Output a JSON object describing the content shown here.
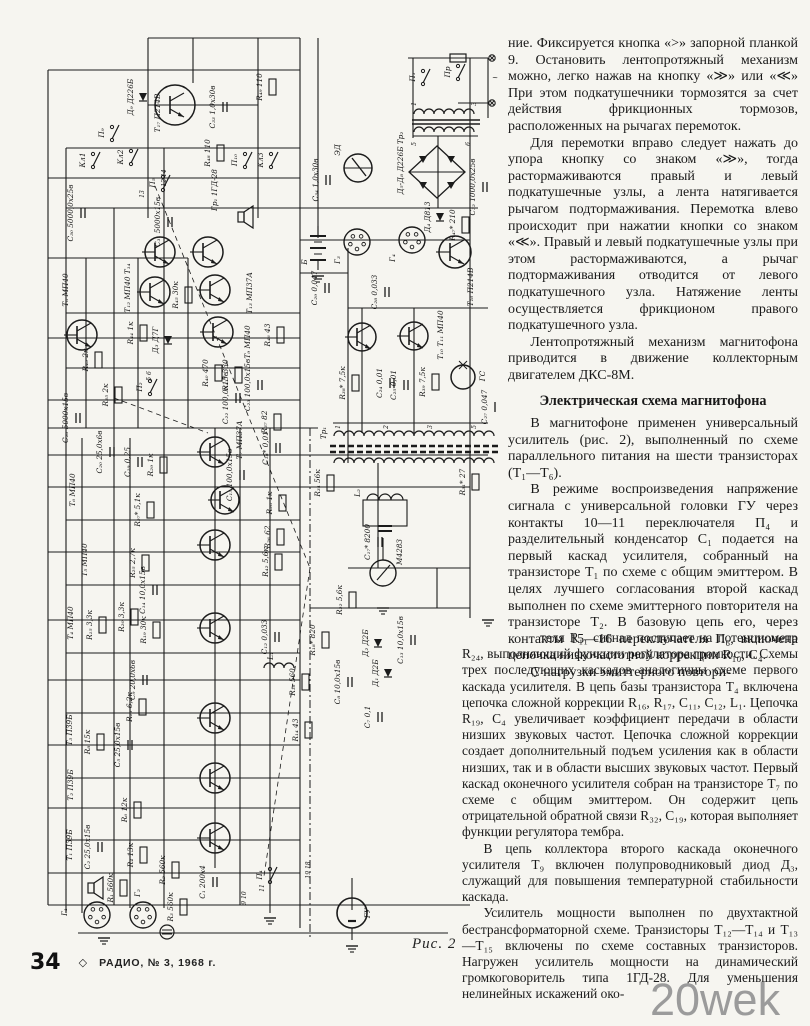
{
  "page": {
    "background": "#f6f5f0",
    "ink": "#1b1b1b"
  },
  "article": {
    "column_top": [
      {
        "style": "cont",
        "text": "ние. Фиксируется кнопка «>» запорной планкой 9. Остановить лентопротяжный механизм можно, легко нажав на кнопку «≫» или «≪» При этом подкатушечники тормозятся за счет действия фрикционных тормозов, расположенных на рычагах перемоток."
      },
      {
        "style": "p",
        "text": "Для перемотки вправо следует нажать до упора кнопку со знаком «≫», тогда растормаживаются правый и левый подкатушечные узлы, а лента натягивается рычагом подтормаживания. Перемотка влево происходит при нажатии кнопки со знаком «≪». Правый и левый подкатушечные узлы при этом растормаживаются, а рычаг подтормаживания отводится от левого подкатушечного узла. Натяжение ленты осуществляется фрикционом правого подкатушечного узла."
      },
      {
        "style": "p",
        "text": "Лентопротяжный механизм магнитофона приводится в движение коллекторным двигателем ДКС-8М."
      },
      {
        "style": "h",
        "text": "Электрическая схема магнитофона"
      },
      {
        "style": "p",
        "text": "В магнитофоне применен универсальный усилитель (рис. 2), выполненный по схеме параллельного питания на шести транзисторах (Т₁—Т₆)."
      },
      {
        "style": "p",
        "text": "В режиме воспроизведения напряжение сигнала с универсальной головки ГУ через контакты 10—11 переключателя П₄ и разделительный конденсатор С₁ подается на первый каскад усилителя, собранный на транзисторе Т₁ по схеме с общим эмиттером. В целях лучшего согласования второй каскад выполнен по схеме эмиттерного повторителя на транзисторе Т₂. В базовую цепь его, через контакты 15—16 переключателя П₆, включена цепочка низкочастотной коррекции R₁₀, С₄."
      },
      {
        "style": "p",
        "text": "С нагрузки эмиттерного повтори-"
      }
    ],
    "column_bottom": [
      {
        "style": "contind",
        "text": "теля R₁₁ сигнал поступает на потенциометр R₂₄, выполняющий функции регулятора громкости. Схемы трех последующих каскадов аналогичны схеме первого каскада усилителя. В цепь базы транзистора Т₄ включена цепочка сложной коррекции R₁₆, R₁₇, С₁₁, С₁₂, L₁. Цепочка R₁₉, С₄ увеличивает коэффициент передачи в области низших звуковых частот. Цепочка сложной коррекции создает дополнительный подъем усиления как в области низших, так и в области высших звуковых частот. Первый каскад оконечного усилителя собран на транзисторе Т₇ по схеме с общим эмиттером. Он содержит цепь отрицательной обратной связи R₃₂, С₁₉, которая выполняет функции регулятора тембра."
      },
      {
        "style": "p",
        "text": "В цепь коллектора второго каскада оконечного усилителя Т₉ включен полупроводниковый диод Д₃, служащий для повышения температурной стабильности каскада."
      },
      {
        "style": "p",
        "text": "Усилитель мощности выполнен по двухтактной бестрансформаторной схеме. Транзисторы Т₁₂—Т₁₄ и Т₁₃—Т₁₅ включены по схеме составных транзисторов. Нагружен усилитель мощности на динамический громкоговоритель типа 1ГД-28. Для уменьшения нелинейных искажений око-"
      }
    ]
  },
  "figure": {
    "caption": "Рис. 2",
    "labels": [
      {
        "t": "Д₉ Д226Б",
        "x": 115,
        "y": 89
      },
      {
        "t": "Т₁₇ П214В",
        "x": 142,
        "y": 105
      },
      {
        "t": "С₃₃ 1,0х30в",
        "x": 197,
        "y": 99
      },
      {
        "t": "R₄₉ 110",
        "x": 244,
        "y": 79
      },
      {
        "t": "R₄₈ 110",
        "x": 192,
        "y": 145
      },
      {
        "t": "П₉",
        "x": 86,
        "y": 125
      },
      {
        "t": "Кл1",
        "x": 67,
        "y": 152
      },
      {
        "t": "Кл2",
        "x": 105,
        "y": 149
      },
      {
        "t": "Кл3",
        "x": 245,
        "y": 152
      },
      {
        "t": "П₁₀",
        "x": 219,
        "y": 152
      },
      {
        "t": "П₅",
        "x": 137,
        "y": 175
      },
      {
        "t": "12 14",
        "x": 148,
        "y": 170,
        "s": 1
      },
      {
        "t": "13",
        "x": 126,
        "y": 186,
        "s": 1
      },
      {
        "t": "Гр₁ 1ГД-28",
        "x": 199,
        "y": 182
      },
      {
        "t": "С₃₀ 5000,0х25в",
        "x": 55,
        "y": 205
      },
      {
        "t": "С₃₁ 5000х15в",
        "x": 142,
        "y": 214
      },
      {
        "t": "П₁",
        "x": 397,
        "y": 69
      },
      {
        "t": "Пр",
        "x": 432,
        "y": 64
      },
      {
        "t": "~",
        "x": 477,
        "y": 72,
        "r": 0
      },
      {
        "t": "Д₅-Д₈ Д226Б  Тр₂",
        "x": 385,
        "y": 155
      },
      {
        "t": "1",
        "x": 398,
        "y": 96,
        "s": 1
      },
      {
        "t": "3",
        "x": 458,
        "y": 96,
        "s": 1
      },
      {
        "t": "5",
        "x": 398,
        "y": 136,
        "s": 1
      },
      {
        "t": "6",
        "x": 452,
        "y": 136,
        "s": 1
      },
      {
        "t": "ЭД",
        "x": 322,
        "y": 142
      },
      {
        "t": "С₃₄ 1,0х30в",
        "x": 300,
        "y": 172
      },
      {
        "t": "С₃₂ 1000,0х25в",
        "x": 457,
        "y": 179
      },
      {
        "t": "Д₄ Д813",
        "x": 412,
        "y": 209
      },
      {
        "t": "Б",
        "x": 289,
        "y": 254
      },
      {
        "t": "Г₃",
        "x": 322,
        "y": 252
      },
      {
        "t": "Г₄",
        "x": 377,
        "y": 250
      },
      {
        "t": "Т₁₆ П214В",
        "x": 455,
        "y": 279
      },
      {
        "t": "R₄₇* 210",
        "x": 437,
        "y": 217
      },
      {
        "t": "С₂₈ 0,033",
        "x": 359,
        "y": 284
      },
      {
        "t": "С₂₉ 0,047",
        "x": 299,
        "y": 280
      },
      {
        "t": "Т₁₀ Т₁₁ МП40",
        "x": 425,
        "y": 327
      },
      {
        "t": "R₃₈* 7,5к",
        "x": 327,
        "y": 375
      },
      {
        "t": "R₃₉ 7,5к",
        "x": 407,
        "y": 374
      },
      {
        "t": "С₂₄ 0,01",
        "x": 364,
        "y": 375
      },
      {
        "t": "С₂₅ 0,01",
        "x": 378,
        "y": 377
      },
      {
        "t": "ГС",
        "x": 467,
        "y": 368
      },
      {
        "t": "С₂₇ 0,047",
        "x": 469,
        "y": 399
      },
      {
        "t": "Тр₁",
        "x": 308,
        "y": 425
      },
      {
        "t": "1",
        "x": 322,
        "y": 419,
        "s": 1
      },
      {
        "t": "2",
        "x": 370,
        "y": 419,
        "s": 1
      },
      {
        "t": "3",
        "x": 414,
        "y": 419,
        "s": 1
      },
      {
        "t": "5",
        "x": 458,
        "y": 419,
        "s": 1
      },
      {
        "t": "Т₈ МП40",
        "x": 50,
        "y": 282
      },
      {
        "t": "Т₁₂ МП40 Т₁₄",
        "x": 112,
        "y": 280
      },
      {
        "t": "Т₁₃ МП37А",
        "x": 234,
        "y": 285
      },
      {
        "t": "R₄₄ 1к",
        "x": 115,
        "y": 325
      },
      {
        "t": "R₄₅ 30к",
        "x": 160,
        "y": 287
      },
      {
        "t": "Д₃ Д7Г",
        "x": 140,
        "y": 332
      },
      {
        "t": "Т₉ МП40",
        "x": 232,
        "y": 334
      },
      {
        "t": "R₄₃ 2к",
        "x": 70,
        "y": 352
      },
      {
        "t": "R₃₅ 2к",
        "x": 90,
        "y": 387
      },
      {
        "t": "С₂₆ 5000х15в",
        "x": 50,
        "y": 410
      },
      {
        "t": "R₄₀ 470",
        "x": 190,
        "y": 365
      },
      {
        "t": "R₄₁* 330",
        "x": 210,
        "y": 367
      },
      {
        "t": "С₂₃ 100,0х15в",
        "x": 232,
        "y": 377
      },
      {
        "t": "R₄₆ 43",
        "x": 252,
        "y": 327
      },
      {
        "t": "R₃₇ 82",
        "x": 249,
        "y": 414
      },
      {
        "t": "П₂",
        "x": 124,
        "y": 379
      },
      {
        "t": "5 6",
        "x": 133,
        "y": 368,
        "s": 1
      },
      {
        "t": "С₂₂ 100,0х15в",
        "x": 210,
        "y": 390
      },
      {
        "t": "Т₆ МП40",
        "x": 57,
        "y": 482
      },
      {
        "t": "Т₅ МП40",
        "x": 69,
        "y": 552
      },
      {
        "t": "Т₄ МП40",
        "x": 55,
        "y": 615
      },
      {
        "t": "С₂₀ 25,0х6в",
        "x": 84,
        "y": 444
      },
      {
        "t": "С₁₉ 0,25",
        "x": 112,
        "y": 454
      },
      {
        "t": "R₂₉ 1к",
        "x": 135,
        "y": 457
      },
      {
        "t": "R₂₇* 5,1к",
        "x": 122,
        "y": 502
      },
      {
        "t": "R₂₅ 2,7к",
        "x": 117,
        "y": 555
      },
      {
        "t": "С₁₄ 10,0х15в",
        "x": 127,
        "y": 582
      },
      {
        "t": "R₂₀ 3,3к",
        "x": 106,
        "y": 609
      },
      {
        "t": "R₁₉ 30к",
        "x": 128,
        "y": 622
      },
      {
        "t": "R₁₅ 3,3к",
        "x": 74,
        "y": 617
      },
      {
        "t": "Т₃ П39Б",
        "x": 54,
        "y": 722
      },
      {
        "t": "Т₂ П39Б",
        "x": 55,
        "y": 777
      },
      {
        "t": "Т₁ П39Б",
        "x": 54,
        "y": 837
      },
      {
        "t": "R₁₃ 6,2к",
        "x": 114,
        "y": 699
      },
      {
        "t": "С₉ 20,0х6в",
        "x": 117,
        "y": 672
      },
      {
        "t": "R₈ 15к",
        "x": 72,
        "y": 734
      },
      {
        "t": "С₅ 25,0х15в",
        "x": 102,
        "y": 737
      },
      {
        "t": "R₆ 12к",
        "x": 109,
        "y": 802
      },
      {
        "t": "С₂ 25,0х15в",
        "x": 72,
        "y": 839
      },
      {
        "t": "R₄ 13к",
        "x": 115,
        "y": 847
      },
      {
        "t": "R₁ 560к",
        "x": 95,
        "y": 880
      },
      {
        "t": "R₂ 560к",
        "x": 147,
        "y": 862
      },
      {
        "t": "Г₁",
        "x": 49,
        "y": 904
      },
      {
        "t": "Г₂",
        "x": 122,
        "y": 885
      },
      {
        "t": "R₃ 560к",
        "x": 155,
        "y": 899
      },
      {
        "t": "С₁ 200х4",
        "x": 187,
        "y": 874
      },
      {
        "t": "П₄",
        "x": 244,
        "y": 867
      },
      {
        "t": "9 10",
        "x": 228,
        "y": 890,
        "s": 1
      },
      {
        "t": "11",
        "x": 246,
        "y": 880,
        "s": 1
      },
      {
        "t": "19 18",
        "x": 292,
        "y": 862,
        "s": 1
      },
      {
        "t": "ГУ",
        "x": 352,
        "y": 905
      },
      {
        "t": "L₂",
        "x": 342,
        "y": 485
      },
      {
        "t": "С₁₇* 8200",
        "x": 352,
        "y": 534
      },
      {
        "t": "М4283",
        "x": 384,
        "y": 544
      },
      {
        "t": "R₃₁* 27",
        "x": 447,
        "y": 474
      },
      {
        "t": "R₂₂ 5,6к",
        "x": 324,
        "y": 592
      },
      {
        "t": "Т₇ МП37А",
        "x": 224,
        "y": 432
      },
      {
        "t": "С₁₈* 0,01",
        "x": 250,
        "y": 440
      },
      {
        "t": "R₃₄ 56к",
        "x": 302,
        "y": 475
      },
      {
        "t": "R₂₈ 1к",
        "x": 254,
        "y": 495
      },
      {
        "t": "R₂₆ 62",
        "x": 252,
        "y": 529
      },
      {
        "t": "R₄₂ 5,6к",
        "x": 250,
        "y": 554
      },
      {
        "t": "С₁₅ 100,0х15в",
        "x": 214,
        "y": 467
      },
      {
        "t": "С₁₂ 0,033",
        "x": 249,
        "y": 629
      },
      {
        "t": "L₁",
        "x": 255,
        "y": 648
      },
      {
        "t": "R₁₈* 820",
        "x": 297,
        "y": 632
      },
      {
        "t": "R₁₆ 560",
        "x": 277,
        "y": 674
      },
      {
        "t": "R₁₄ 43",
        "x": 280,
        "y": 722
      },
      {
        "t": "Д₂ Д2Б",
        "x": 350,
        "y": 635
      },
      {
        "t": "Д₁ Д2Б",
        "x": 360,
        "y": 665
      },
      {
        "t": "С₁₃ 10,0х15в",
        "x": 385,
        "y": 632
      },
      {
        "t": "С₈ 10,0х15в",
        "x": 322,
        "y": 674
      },
      {
        "t": "С₇ 0,1",
        "x": 352,
        "y": 709
      }
    ]
  },
  "footer": {
    "page_number": "34",
    "diamond": "◇",
    "journal": "РАДИО, № 3, 1968 г."
  },
  "watermark": "20wek"
}
